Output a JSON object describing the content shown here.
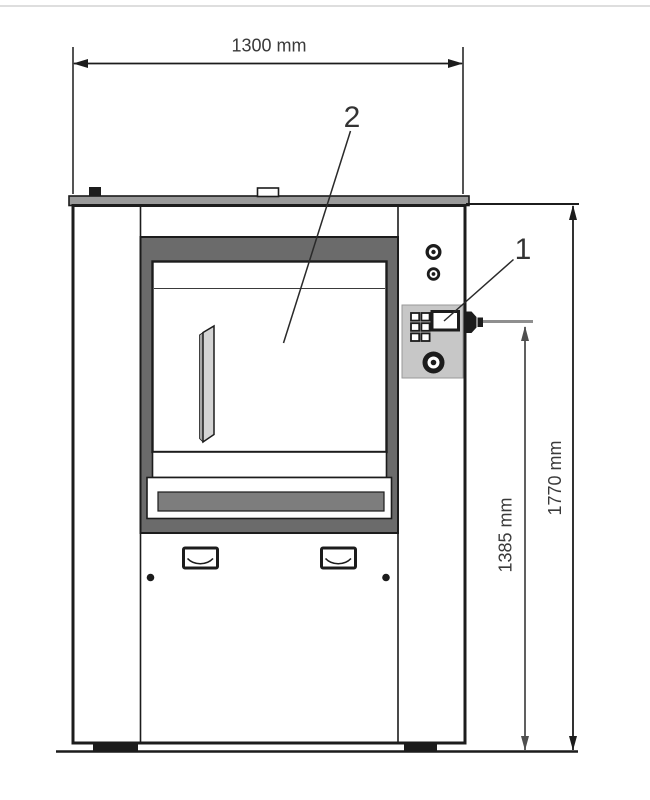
{
  "page": {
    "background": "#ffffff",
    "top_divider_color": "#d4d4d4"
  },
  "drawing": {
    "type": "technical-front-view",
    "subject": "industrial washer-extractor front elevation",
    "dimensions": {
      "width": "1300 mm",
      "total_height": "1770 mm",
      "control_height": "1385 mm"
    },
    "callouts": {
      "control_panel": "1",
      "door": "2"
    },
    "colors": {
      "line": "#1c1c1c",
      "dim_primary": "#1c1c1c",
      "dim_secondary_line": "#4f4f4f",
      "dim_extension_gray": "#8f8f8f",
      "text": "#3a3a3a",
      "door_frame": "#6b6b6b",
      "top_lid": "#9a9a9a",
      "control_panel_plate": "#c7c7c7",
      "tray_bar": "#7d7d7d",
      "door_handle": "#d4d4d4",
      "handle_side_shade": "#a8a8a8"
    }
  }
}
